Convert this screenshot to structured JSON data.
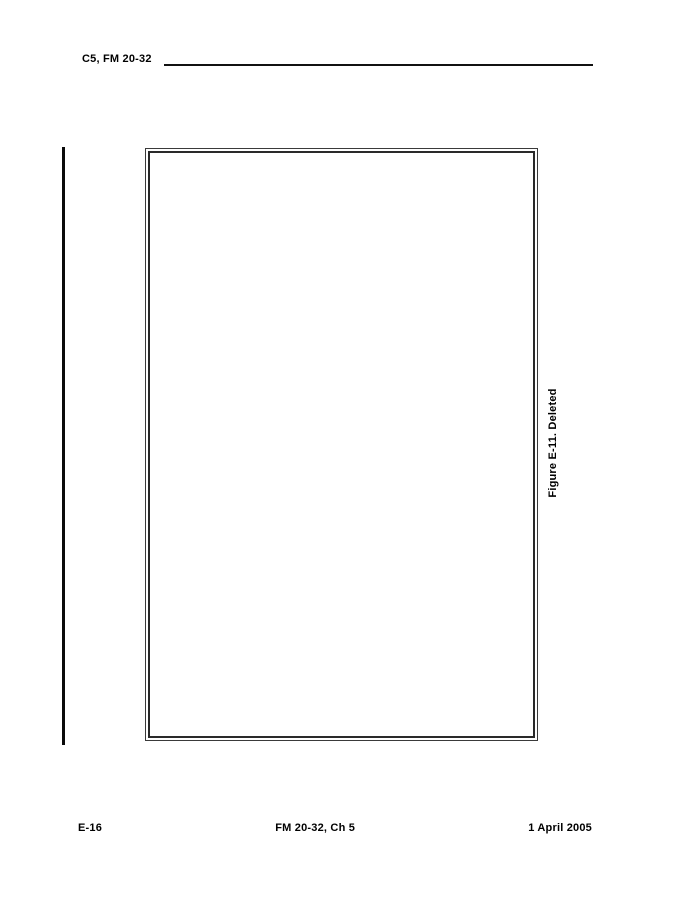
{
  "document": {
    "header": {
      "title": "C5, FM 20-32"
    },
    "figure": {
      "caption": "Figure E-11. Deleted"
    },
    "footer": {
      "page_number": "E-16",
      "manual_ref": "FM 20-32, Ch 5",
      "date": "1 April 2005"
    }
  }
}
